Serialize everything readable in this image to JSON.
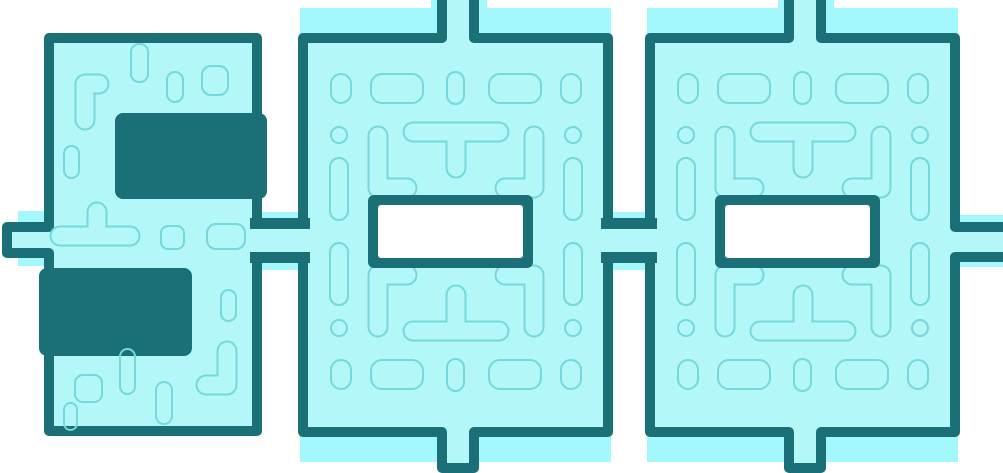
{
  "illustration": {
    "title": "500",
    "description": "The number 500 rendered as three connected teal maze puzzle blocks on a white background",
    "digits": [
      "5",
      "0",
      "0"
    ],
    "colors": {
      "background": "#ffffff",
      "fill": "#b4f7f9",
      "glow": "#a2f8fd",
      "border": "#1b6f76",
      "maze_line": "#74d8dc",
      "hole": "#ffffff"
    }
  }
}
